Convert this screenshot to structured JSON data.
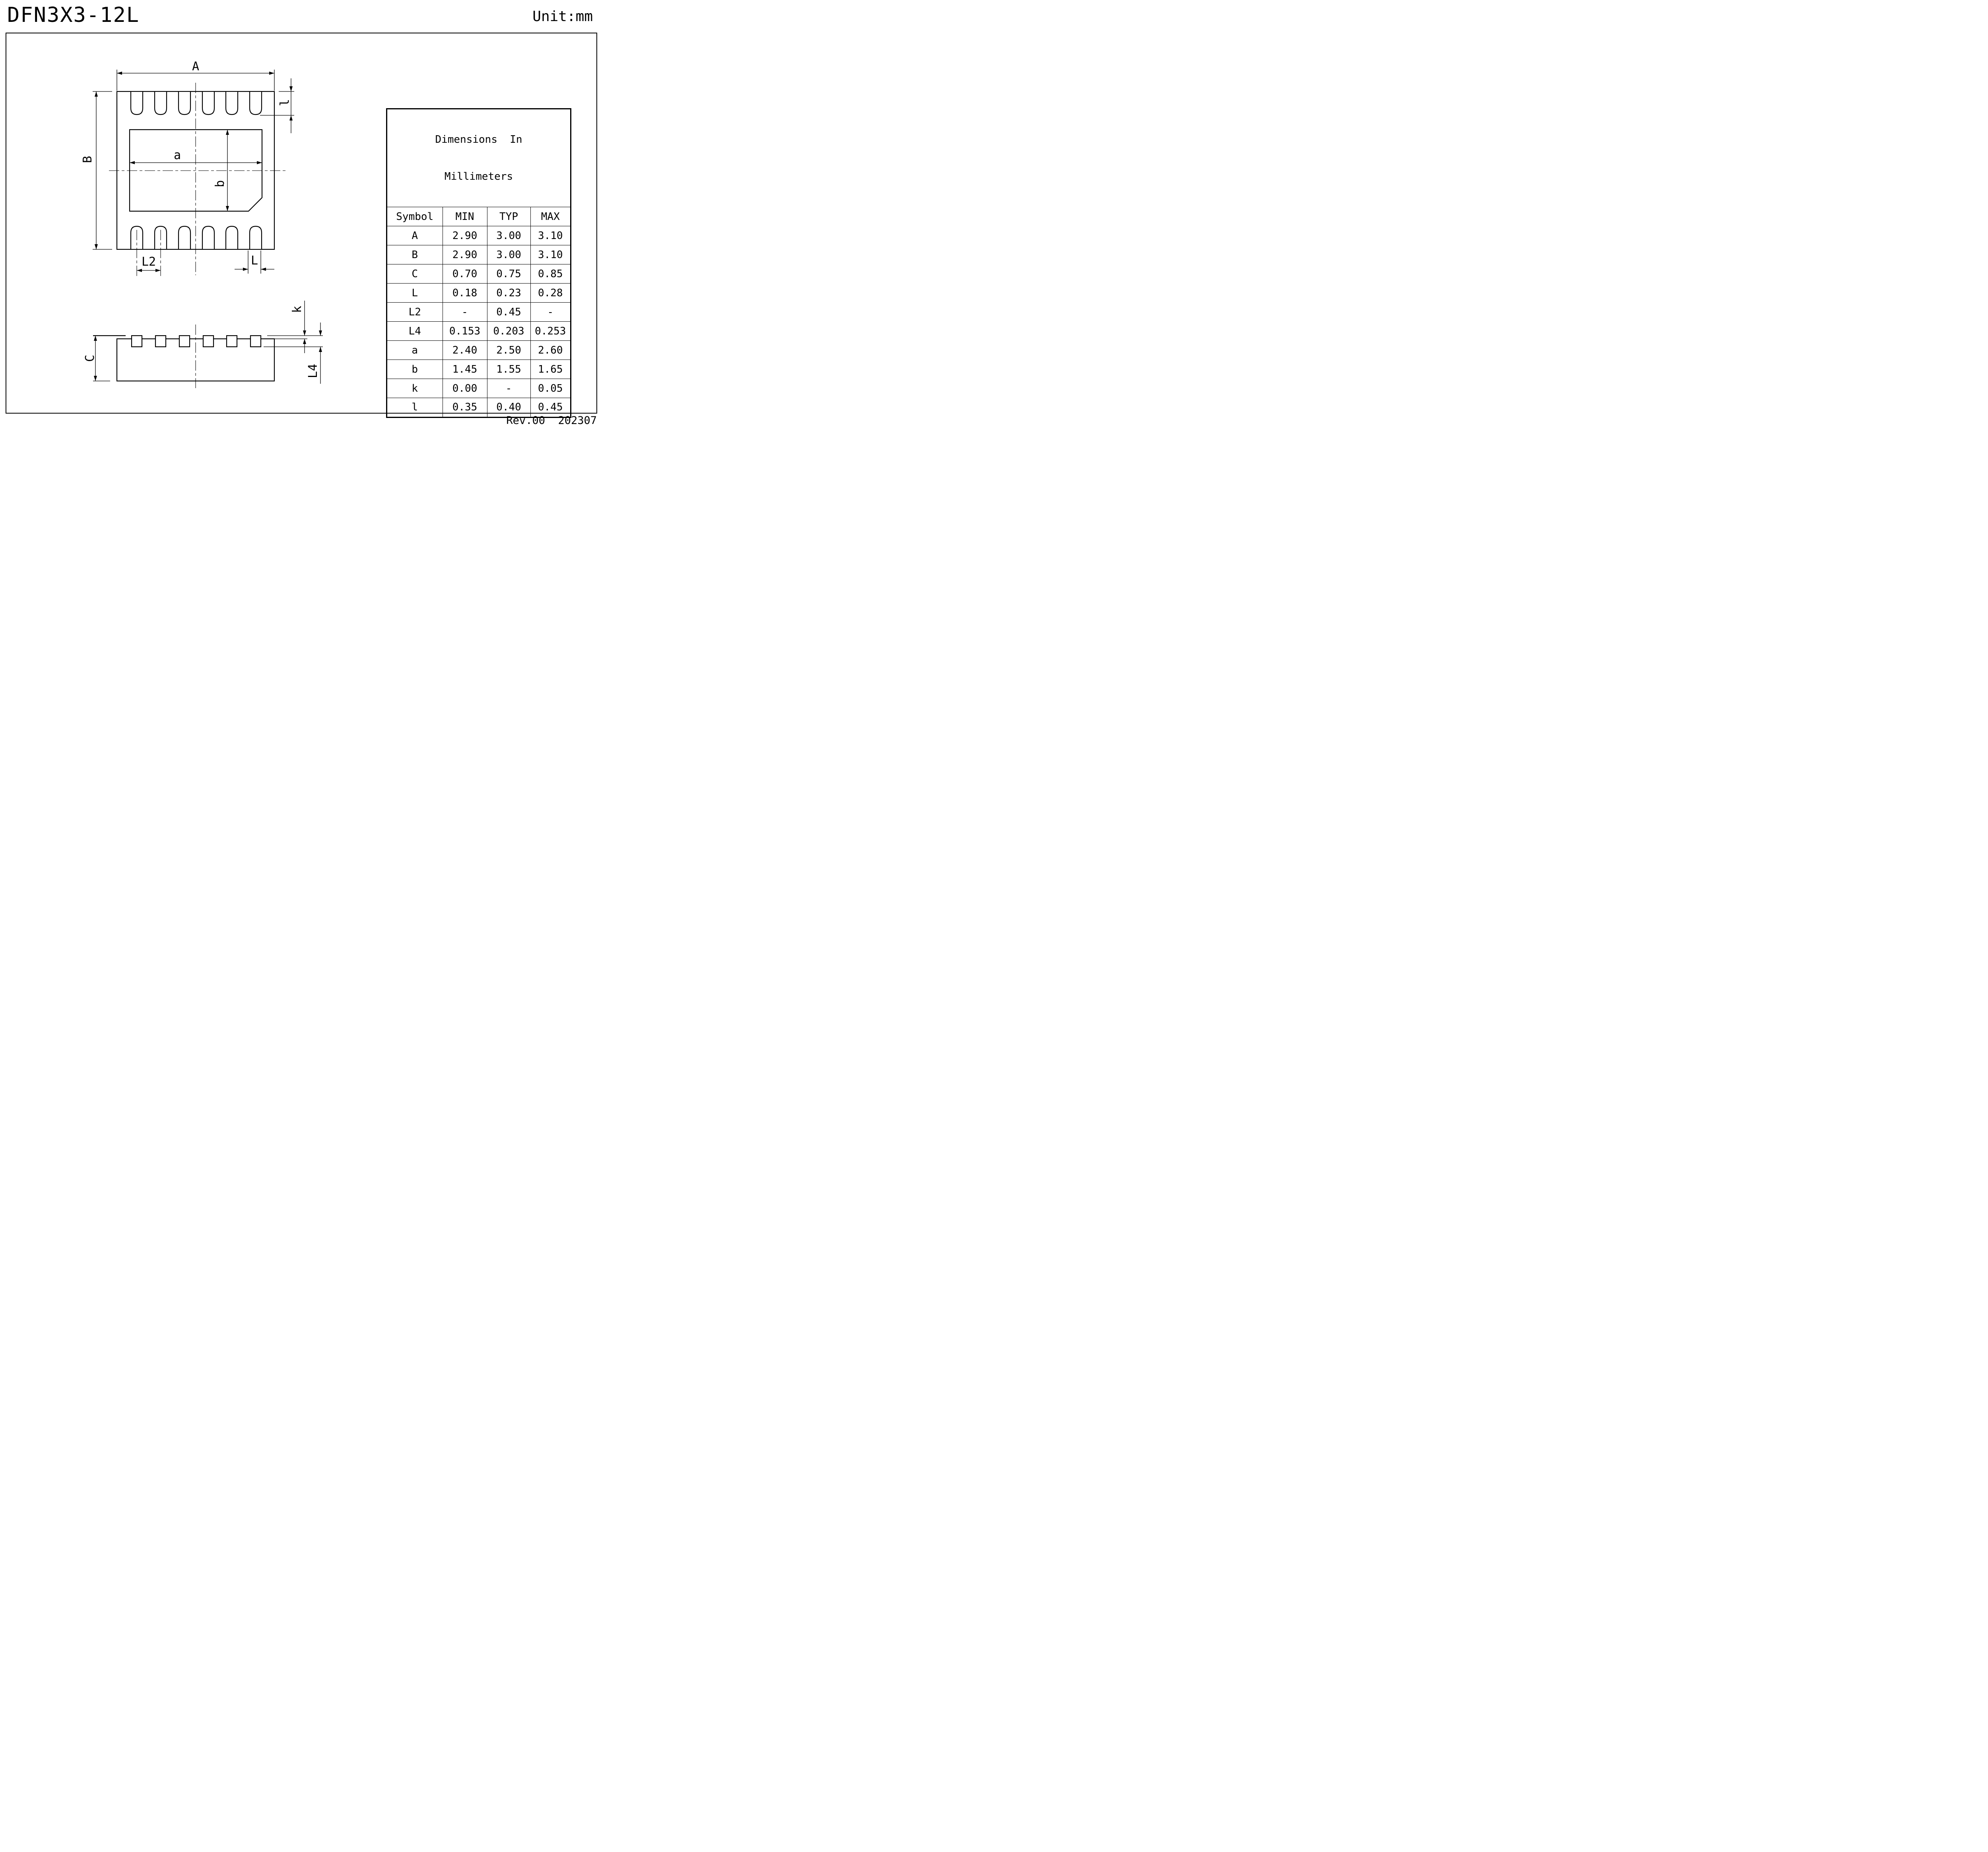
{
  "page": {
    "title": "DFN3X3-12L",
    "unit_label": "Unit:mm",
    "revision": "Rev.00  202307"
  },
  "drawing": {
    "labels": {
      "A": "A",
      "B": "B",
      "a": "a",
      "b": "b",
      "l_small": "l",
      "L2": "L2",
      "L": "L",
      "C": "C",
      "k": "k",
      "L4": "L4"
    }
  },
  "table": {
    "title_line1": "Dimensions  In",
    "title_line2": "Millimeters",
    "columns": [
      "Symbol",
      "MIN",
      "TYP",
      "MAX"
    ],
    "rows": [
      {
        "symbol": "A",
        "min": "2.90",
        "typ": "3.00",
        "max": "3.10"
      },
      {
        "symbol": "B",
        "min": "2.90",
        "typ": "3.00",
        "max": "3.10"
      },
      {
        "symbol": "C",
        "min": "0.70",
        "typ": "0.75",
        "max": "0.85"
      },
      {
        "symbol": "L",
        "min": "0.18",
        "typ": "0.23",
        "max": "0.28"
      },
      {
        "symbol": "L2",
        "min": "-",
        "typ": "0.45",
        "max": "-"
      },
      {
        "symbol": "L4",
        "min": "0.153",
        "typ": "0.203",
        "max": "0.253"
      },
      {
        "symbol": "a",
        "min": "2.40",
        "typ": "2.50",
        "max": "2.60"
      },
      {
        "symbol": "b",
        "min": "1.45",
        "typ": "1.55",
        "max": "1.65"
      },
      {
        "symbol": "k",
        "min": "0.00",
        "typ": "-",
        "max": "0.05"
      },
      {
        "symbol": "l",
        "min": "0.35",
        "typ": "0.40",
        "max": "0.45"
      }
    ]
  }
}
